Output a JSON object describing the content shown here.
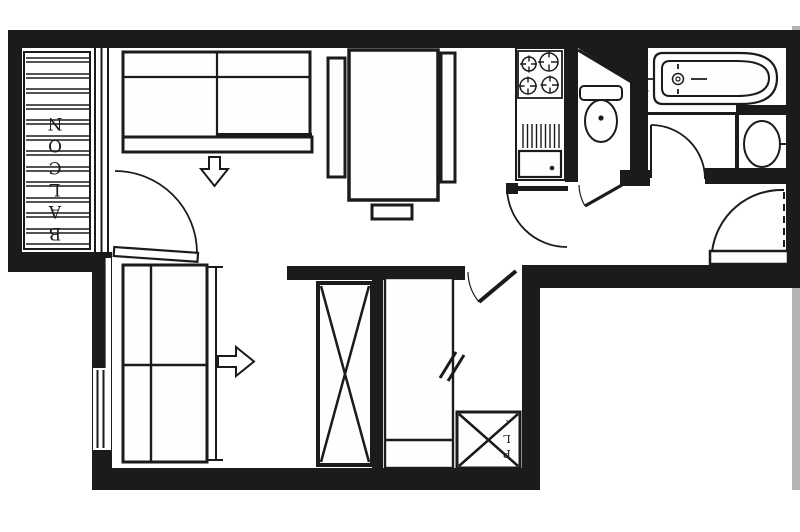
{
  "labels": {
    "balcony": "BALCON",
    "closet": "PL."
  },
  "colors": {
    "ink": "#1b1b1b",
    "paper": "#ffffff",
    "scan_edge": "#b3b3b3"
  }
}
